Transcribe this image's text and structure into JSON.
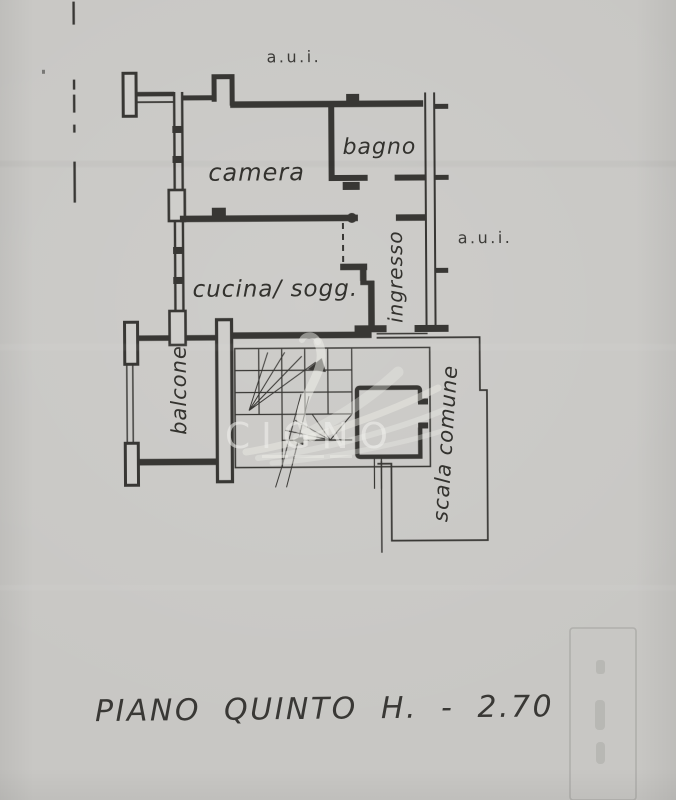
{
  "labels": {
    "camera": "camera",
    "bagno": "bagno",
    "cucina_sogg": "cucina/ sogg.",
    "ingresso": "ingresso",
    "balcone": "balcone",
    "scala_comune": "scala comune"
  },
  "adjacents": {
    "top": "a.u.i.",
    "right": "a.u.i."
  },
  "caption": {
    "text": "PIANO QUINTO H. - 2.70"
  },
  "watermark": {
    "text": "CIGNO"
  },
  "colors": {
    "paper": "#c8c7c4",
    "ink": "#2f2e2b",
    "watermark_tint": "#eeeeea"
  }
}
